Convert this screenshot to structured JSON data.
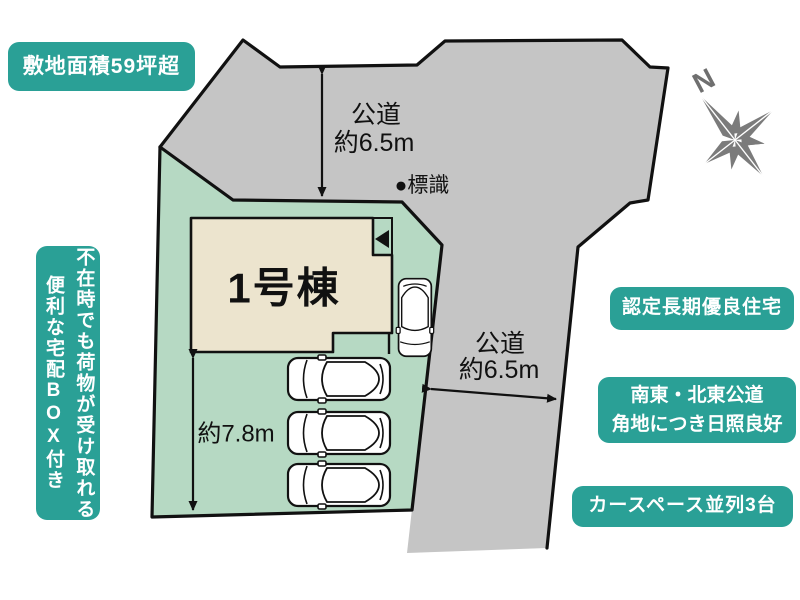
{
  "badges": {
    "site_area": {
      "label": "敷地面積59坪超"
    },
    "delivery_box": {
      "label": "不在時でも荷物が受け取れる\n便利な宅配BOX付き"
    },
    "certified": {
      "label": "認定長期優良住宅"
    },
    "corner_sunlight": {
      "label": "南東・北東公道\n角地につき日照良好"
    },
    "car_space": {
      "label": "カースペース並列3台"
    }
  },
  "plan": {
    "building": {
      "label": "1号棟"
    },
    "north": {
      "label": "N"
    },
    "sign": {
      "label": "●標識"
    },
    "road_top": {
      "label": "公道",
      "width_label": "約6.5m"
    },
    "road_right": {
      "label": "公道",
      "width_label": "約6.5m"
    },
    "lot_depth": {
      "label": "約7.8m"
    },
    "parking": {
      "visible_car_count": 4
    }
  },
  "colors": {
    "badge_teal": "#2aa096",
    "lot_green": "#b6d9c3",
    "road_gray": "#c5c5c5",
    "building_beige": "#ece4ce",
    "line_black": "#111111",
    "compass_gray": "#7b7b7b"
  }
}
